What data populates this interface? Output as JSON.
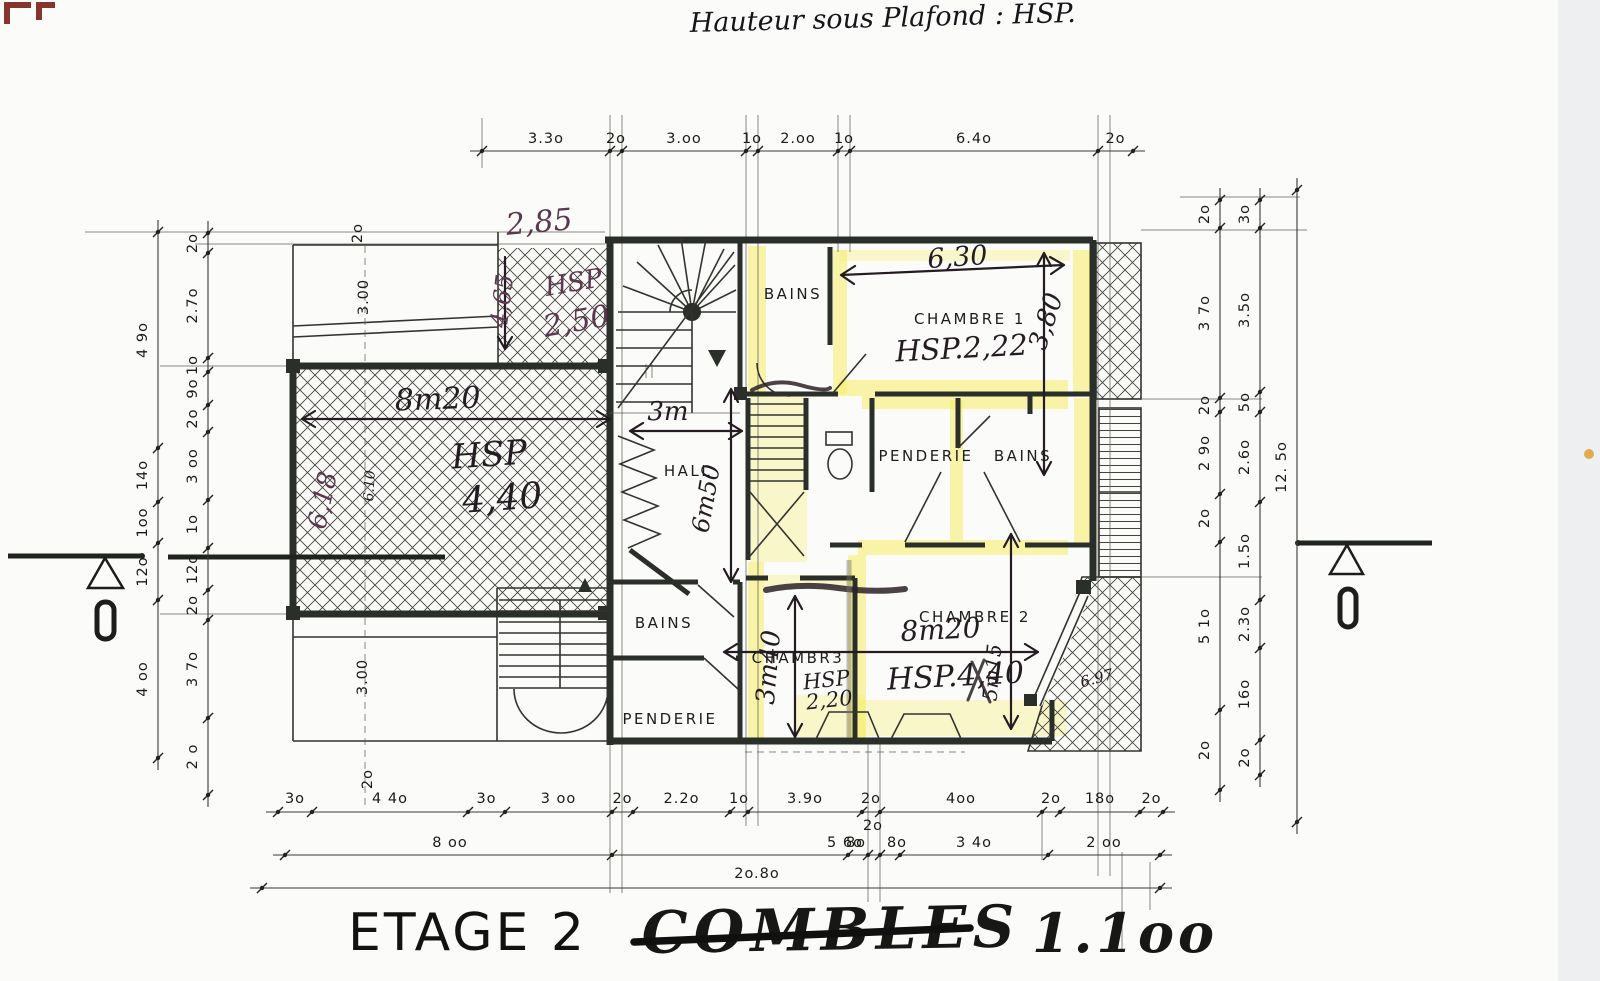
{
  "note_top": "Hauteur sous Plafond : HSP.",
  "title": {
    "floor": "ETAGE 2",
    "name_crossed": "COMBLES",
    "scale": "1.1oo"
  },
  "section_letter": "D",
  "colors": {
    "paper": "#fbfbf9",
    "ink": "#1b1b18",
    "wall": "#2b2f2a",
    "highlight_yellow": "#f6ec64",
    "handwriting": "#241c22",
    "handwriting_purple": "#5b3750",
    "corner_mark_red": "#7c1d18",
    "edge_dot_orange": "#e2a23c"
  },
  "rooms": [
    "BAINS",
    "CHAMBRE 1",
    "HALL",
    "PENDERIE",
    "BAINS",
    "BAINS",
    "PENDERIE",
    "CHAMBR3",
    "CHAMBRE 2"
  ],
  "hand_labels": [
    "2,85",
    "4,65",
    "HSP",
    "2,50",
    "8m20",
    "HSP",
    "4,40",
    "6,18",
    "6.10",
    "3m",
    "6m50",
    "6,30",
    "3,80",
    "HSP.2,22",
    "3m40",
    "HSP",
    "2,20",
    "8m20",
    "HSP.4,40",
    "5m15",
    "6.97"
  ],
  "dims": {
    "top": [
      "3.3o",
      "2o",
      "3.oo",
      "1o",
      "2.oo",
      "1o",
      "6.4o",
      "2o"
    ],
    "bottom1": [
      "3o",
      "4 4o",
      "3o",
      "3 oo",
      "2o",
      "2.2o",
      "1o",
      "3.9o",
      "2o",
      "4oo",
      "2o",
      "18o",
      "2o"
    ],
    "bottom2": [
      "8 oo",
      "5 6o",
      "8o",
      "2o",
      "8o",
      "3 4o",
      "2 oo"
    ],
    "bottom3": [
      "2o.8o"
    ],
    "left_outer": [
      "4 9o",
      "14o",
      "1oo",
      "12o",
      "4 oo"
    ],
    "left_inner": [
      "2o",
      "2.7o",
      "1o",
      "9o",
      "2o",
      "3 oo",
      "1o",
      "12o",
      "2o",
      "3 7o",
      "2 o"
    ],
    "right_inner": [
      "2o",
      "3 7o",
      "2o",
      "2 9o",
      "2o",
      "5 1o",
      "2o"
    ],
    "right_mid": [
      "3o",
      "3.5o",
      "5o",
      "2.6o",
      "1.5o",
      "2.3o",
      "16o",
      "2o"
    ],
    "right_outer": [
      "12. 5o"
    ],
    "inner": [
      "3.00",
      "3.00",
      "2o",
      "2o"
    ]
  }
}
